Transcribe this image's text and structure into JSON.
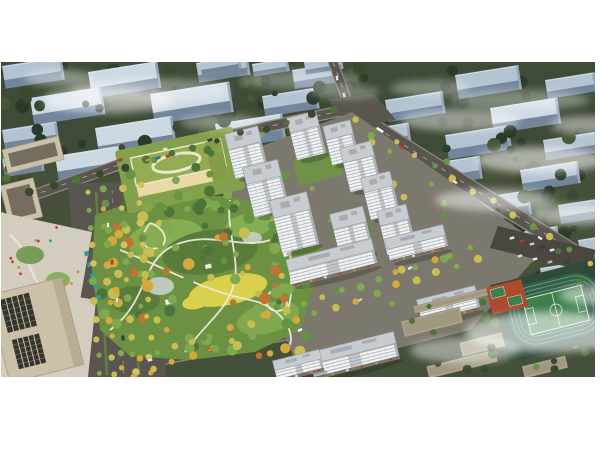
{
  "image": {
    "x": 1,
    "y": 62,
    "width": 594,
    "height": 315,
    "description": "Aerial rendering of a residential masterplan: white high-rise apartment towers around green courtyards, a large landscaped central park with winding paths, a green-roofed kindergarten, beige office buildings on the west, retail mid-rises, a school campus with running track and sports field to the southeast, surrounded by rows of existing slab housing under light mist"
  },
  "palette": {
    "white": "#ffffff",
    "bgGround": "#45503a",
    "bgGroundDark": "#3b4733",
    "dark1": "#2c3a2b",
    "dark2": "#39492f",
    "dark3": "#465739",
    "slabRoof": "#b4c3d1",
    "slabRoofLight": "#ccd8e2",
    "slabFace": "#73859a",
    "slabEnd": "#92a4b4",
    "road": "#5a564f",
    "roadDark": "#4d4a44",
    "roadLine": "#d8d3c7",
    "sidewalk": "#8f8a80",
    "parcel": "#7d786d",
    "towerRoof": "#c7ccd1",
    "towerRoofEdge": "#99a0a7",
    "towerSide": "#a9b0b7",
    "towerBox": "#a5acb2",
    "towerShadow": "rgba(30,35,30,0.28)",
    "courtyard": "#5e8142",
    "podium": "#6f9149",
    "podium2": "#68894a",
    "parkBase": "#6d9142",
    "parkLight": "#86ad51",
    "parkDark": "#597c3a",
    "lawnYellow": "#d9d04b",
    "pond": "#c5d0c9",
    "path": "#efe9da",
    "g1": "#4d7338",
    "g2": "#679344",
    "g3": "#7fa84f",
    "tY": "#c8bd52",
    "tY2": "#cfc35a",
    "tGold": "#d5a93e",
    "tOr": "#c07433",
    "schoolRoof": "#94ab51",
    "schoolRoofDark": "#869c49",
    "schoolRing": "#e6e9c6",
    "schoolWall": "#e9d9a4",
    "schoolWallLight": "#f2ead2",
    "schoolLawn": "#85a04c",
    "beige": "#cbc0a8",
    "beigeDark": "#a89c82",
    "officeWin": "#35352f",
    "plaza": "#d3cdc0",
    "canopy": "#2f9e98",
    "campusBeige": "#b3a98f",
    "campusEdge": "#8f8570",
    "campusRoof": "#8d8672",
    "trackGround": "#2f4a3a",
    "trackGreen": "#326147",
    "trackLane": "#86a695",
    "pitchGreen": "#3f7f4b",
    "pitchLine": "#d9e6da",
    "courtRed": "#b04a2e",
    "parking": "#4a4741",
    "shopStrip": "#77726a",
    "awn1": "#c23b2e",
    "awn2": "#d98a2b",
    "awn3": "#ededed"
  },
  "scene": {
    "bgTrees1": [
      {
        "x": 0,
        "y": 62,
        "w": 360,
        "h": 108,
        "n": 60,
        "r": [
          3,
          8
        ],
        "colors": [
          "dark1",
          "dark2",
          "dark3"
        ],
        "seed": 11
      },
      {
        "x": 340,
        "y": 62,
        "w": 255,
        "h": 72,
        "n": 32,
        "r": [
          3,
          7
        ],
        "colors": [
          "dark1",
          "dark2"
        ],
        "seed": 23
      },
      {
        "x": 420,
        "y": 128,
        "w": 175,
        "h": 172,
        "n": 48,
        "r": [
          3,
          8
        ],
        "colors": [
          "dark1",
          "dark2",
          "dark3"
        ],
        "seed": 37
      }
    ],
    "bgSlabs": [
      [
        2,
        66,
        60
      ],
      [
        88,
        72,
        70
      ],
      [
        196,
        63,
        52
      ],
      [
        292,
        70,
        48
      ],
      [
        200,
        62,
        40,
        1
      ],
      [
        252,
        64,
        36,
        1
      ],
      [
        304,
        62,
        38,
        1
      ],
      [
        30,
        98,
        72
      ],
      [
        150,
        94,
        80
      ],
      [
        262,
        96,
        55
      ],
      [
        2,
        130,
        55
      ],
      [
        95,
        128,
        78
      ],
      [
        215,
        124,
        68
      ],
      [
        2,
        158,
        40
      ],
      [
        55,
        156,
        66
      ],
      [
        455,
        75,
        64
      ],
      [
        545,
        80,
        50
      ],
      [
        385,
        100,
        58
      ],
      [
        490,
        108,
        68
      ],
      [
        355,
        131,
        54
      ],
      [
        445,
        135,
        64
      ],
      [
        543,
        140,
        54
      ],
      [
        420,
        165,
        60
      ],
      [
        520,
        170,
        58
      ],
      [
        465,
        200,
        64
      ],
      [
        558,
        205,
        42
      ],
      [
        500,
        235,
        58
      ],
      [
        578,
        240,
        30
      ],
      [
        540,
        268,
        52
      ]
    ],
    "bgTrees2": [
      {
        "x": 0,
        "y": 70,
        "w": 350,
        "h": 100,
        "n": 26,
        "r": [
          3,
          7
        ],
        "colors": [
          "dark1",
          "dark2"
        ],
        "seed": 51
      },
      {
        "x": 430,
        "y": 130,
        "w": 165,
        "h": 165,
        "n": 24,
        "r": [
          3,
          7
        ],
        "colors": [
          "dark1",
          "dark3"
        ],
        "seed": 63
      },
      {
        "x": 0,
        "y": 150,
        "w": 22,
        "h": 120,
        "n": 10,
        "r": [
          3,
          6
        ],
        "colors": [
          "g1",
          "dark2"
        ],
        "seed": 71
      }
    ],
    "mistBack": [
      [
        150,
        90,
        80,
        12,
        0.35
      ],
      [
        300,
        80,
        60,
        9,
        0.3
      ],
      [
        520,
        100,
        70,
        10,
        0.35
      ]
    ],
    "roads": {
      "r1": {
        "pts": "20,200 160,150 345,110",
        "w": 9
      },
      "stub": {
        "pts": "333,62 351,111",
        "w": 8
      },
      "r2": {
        "pts": "348,110 600,268",
        "w": 13
      },
      "south": {
        "pts": "85,374 290,333 505,238",
        "w": 11
      }
    },
    "westAvenue": {
      "poly": "68,184 154,180 166,377 84,377",
      "medians": [
        [
          "96,192",
          "107,375"
        ],
        [
          "124,189",
          "139,375"
        ]
      ]
    },
    "intersection": {
      "poly": "328,99 374,94 396,120 350,128"
    },
    "parcel": {
      "poly": "225,160 352,112 545,248 470,330 310,370 295,360 230,205"
    },
    "parcelTrees": {
      "x": 235,
      "y": 135,
      "w": 215,
      "h": 170,
      "n": 34,
      "r": [
        2,
        4.5
      ],
      "colors": [
        "g2",
        "g3",
        "tY"
      ],
      "seed": 83
    },
    "courtyards": [
      {
        "cx": 318,
        "cy": 168,
        "w": 46,
        "h": 26,
        "rot": -14,
        "color": "podium"
      },
      {
        "cx": 352,
        "cy": 232,
        "w": 38,
        "h": 22,
        "rot": -14,
        "color": "podium2"
      },
      {
        "cx": 268,
        "cy": 238,
        "w": 30,
        "h": 18,
        "rot": -14,
        "color": "courtyard"
      }
    ],
    "park": {
      "poly": "95,215 150,196 230,196 300,214 322,250 310,300 300,330 255,352 190,360 130,356 100,330 92,270",
      "patches": [
        [
          165,
          238,
          38,
          18,
          "parkLight",
          -10
        ],
        [
          268,
          318,
          32,
          15,
          "g3",
          -15
        ],
        [
          210,
          252,
          48,
          22,
          "parkDark",
          -8
        ],
        [
          228,
          290,
          40,
          15,
          "lawnYellow",
          -12
        ],
        [
          196,
          302,
          14,
          7,
          "lawnYellow",
          -12
        ],
        [
          250,
          225,
          25,
          12,
          "parkLight",
          -10
        ],
        [
          135,
          300,
          25,
          14,
          "parkDark",
          0
        ],
        [
          295,
          260,
          20,
          12,
          "g2",
          0
        ]
      ],
      "ponds": [
        [
          160,
          286,
          14,
          9
        ],
        [
          252,
          238,
          10,
          6
        ]
      ],
      "paths": [
        "M 110,330 C 150,300 140,260 175,245 C 210,230 240,250 270,240",
        "M 120,250 C 160,265 200,290 250,300 C 280,306 295,330 290,345",
        "M 230,200 C 225,235 245,265 230,295 C 222,313 200,330 185,352",
        "M 300,225 C 280,250 300,290 285,315",
        "M 150,223 C 138,238 142,252 158,248 C 170,244 166,228 150,223",
        "M 270,292 C 262,304 270,314 282,310 C 292,306 286,294 270,292"
      ],
      "pavilions": [
        [
          165,
          300,
          8,
          5
        ],
        [
          205,
          265,
          6,
          4
        ],
        [
          283,
          252,
          7,
          5
        ]
      ]
    },
    "parkTrees": [
      {
        "x": 100,
        "y": 200,
        "w": 212,
        "h": 156,
        "n": 115,
        "r": [
          2.5,
          6
        ],
        "colors": [
          "g1",
          "g2",
          "g2",
          "g3",
          "g3",
          "tY",
          "tGold",
          "tOr"
        ],
        "seed": 97
      },
      {
        "x": 150,
        "y": 194,
        "w": 145,
        "h": 20,
        "n": 18,
        "r": [
          3,
          5.5
        ],
        "colors": [
          "g1",
          "g2",
          "g3"
        ],
        "seed": 101
      }
    ],
    "school": {
      "cx": 180,
      "cy": 170,
      "rot": -12,
      "trees": {
        "x": 118,
        "y": 138,
        "w": 125,
        "h": 72,
        "n": 16,
        "r": [
          3,
          5.5
        ],
        "colors": [
          "g1",
          "g2",
          "g3"
        ],
        "seed": 113
      }
    },
    "officeNW": {
      "bldgs": [
        [
          2,
          150,
          58,
          24
        ],
        [
          0,
          186,
          34,
          40
        ]
      ],
      "garden": {
        "poly": "0,212 92,232 78,312 0,302",
        "dots": {
          "n": 14,
          "x": 8,
          "y": 225,
          "w": 70,
          "h": 75,
          "seed": 131,
          "colors": [
            "canopy",
            "awn2",
            "white",
            "awn1",
            "g3"
          ]
        }
      },
      "canopies": [
        [
          84,
          252
        ],
        [
          87,
          263
        ],
        [
          90,
          274
        ],
        [
          93,
          285
        ],
        [
          96,
          296
        ]
      ]
    },
    "officeTower": {
      "plaza": "0,284 96,300 88,377 0,377",
      "cx": 36,
      "cy": 330
    },
    "towers": [
      [
        243,
        138,
        34,
        16,
        30
      ],
      [
        303,
        122,
        30,
        15,
        28
      ],
      [
        338,
        130,
        28,
        14,
        26
      ],
      [
        262,
        172,
        36,
        17,
        34
      ],
      [
        357,
        152,
        32,
        15,
        30
      ],
      [
        377,
        182,
        30,
        15,
        28
      ],
      [
        290,
        205,
        38,
        18,
        36
      ],
      [
        348,
        218,
        34,
        16,
        32
      ],
      [
        393,
        215,
        30,
        15,
        30
      ]
    ],
    "retail": [
      [
        330,
        255,
        88,
        12,
        16
      ],
      [
        415,
        237,
        60,
        11,
        14
      ],
      [
        352,
        348,
        88,
        12,
        16
      ],
      [
        297,
        360,
        48,
        10,
        12
      ],
      [
        447,
        298,
        60,
        11,
        14
      ]
    ],
    "campus": {
      "bldgs": [
        [
          470,
          296,
          115,
          7
        ],
        [
          432,
          322,
          60,
          16
        ],
        [
          500,
          340,
          80,
          14
        ],
        [
          462,
          364,
          70,
          12
        ],
        [
          545,
          367,
          44,
          12
        ]
      ],
      "parking": "498,226 596,250 588,272 490,248",
      "trees": {
        "x": 405,
        "y": 298,
        "w": 180,
        "h": 74,
        "n": 28,
        "r": [
          2.5,
          5
        ],
        "colors": [
          "g1",
          "g2",
          "dark2"
        ],
        "seed": 143
      }
    },
    "sports": {
      "cx": 556,
      "cy": 310,
      "rot": -14,
      "courtsCx": 507,
      "courtsCy": 297
    },
    "treeLines": [
      {
        "f": [
          30,
          193
        ],
        "t": [
          335,
          108
        ],
        "n": 14,
        "r": 3.5,
        "colors": [
          "dark2",
          "g1"
        ],
        "seed": 3
      },
      {
        "f": [
          356,
          118
        ],
        "t": [
          590,
          262
        ],
        "n": 13,
        "r": 3.2,
        "colors": [
          "g2",
          "tY"
        ],
        "seed": 5
      },
      {
        "f": [
          88,
          192
        ],
        "t": [
          100,
          374
        ],
        "n": 11,
        "r": 3.2,
        "colors": [
          "tY",
          "tY2",
          "tGold",
          "g3"
        ],
        "seed": 7
      },
      {
        "f": [
          103,
          190
        ],
        "t": [
          114,
          374
        ],
        "n": 11,
        "r": 3.2,
        "colors": [
          "tY",
          "tGold",
          "g3"
        ],
        "seed": 9
      },
      {
        "f": [
          122,
          188
        ],
        "t": [
          134,
          374
        ],
        "n": 11,
        "r": 3.2,
        "colors": [
          "tY2",
          "tY",
          "g3"
        ],
        "seed": 13
      },
      {
        "f": [
          140,
          186
        ],
        "t": [
          152,
          374
        ],
        "n": 11,
        "r": 3.2,
        "colors": [
          "tY",
          "tGold",
          "tY2"
        ],
        "seed": 15
      },
      {
        "f": [
          120,
          366
        ],
        "t": [
          470,
          248
        ],
        "n": 20,
        "r": 3.4,
        "colors": [
          "tY",
          "tGold",
          "g3"
        ],
        "seed": 17
      },
      {
        "f": [
          132,
          377
        ],
        "t": [
          478,
          258
        ],
        "n": 18,
        "r": 3.4,
        "colors": [
          "tY",
          "g3",
          "tGold"
        ],
        "seed": 19
      },
      {
        "f": [
          560,
          252
        ],
        "t": [
          592,
          300
        ],
        "n": 6,
        "r": 3.5,
        "colors": [
          "g1",
          "dark2"
        ],
        "seed": 21
      }
    ],
    "cars": [
      [
        120,
        160,
        "#c23b2e",
        -20
      ],
      [
        165,
        149,
        "#e8e8e8",
        -18
      ],
      [
        210,
        140,
        "#3a3f46",
        -18
      ],
      [
        337,
        78,
        "#e8e8e8",
        80
      ],
      [
        344,
        95,
        "#d8d8d8",
        80
      ],
      [
        380,
        130,
        "#ffffff",
        33,
        8
      ],
      [
        402,
        147,
        "#c23b2e",
        33
      ],
      [
        455,
        182,
        "#e8e8e8",
        33
      ],
      [
        498,
        210,
        "#2f343a",
        33
      ],
      [
        540,
        238,
        "#e8e8e8",
        33
      ],
      [
        108,
        225,
        "#e8e8e8",
        87
      ],
      [
        112,
        262,
        "#c23b2e",
        87
      ],
      [
        117,
        300,
        "#dddddd",
        87
      ],
      [
        123,
        338,
        "#33373d",
        87
      ],
      [
        150,
        360,
        "#e8e8e8",
        -10
      ],
      [
        210,
        350,
        "#d98a2b",
        -12
      ],
      [
        300,
        330,
        "#ffffff",
        -25
      ],
      [
        360,
        300,
        "#cccccc",
        -28
      ],
      [
        410,
        268,
        "#e8e8e8",
        -28
      ],
      [
        148,
        160,
        "#c2a32e",
        -18
      ],
      [
        158,
        158,
        "#3a6fb0",
        -18
      ],
      [
        168,
        156,
        "#c23b2e",
        -18
      ],
      [
        178,
        154,
        "#e8e8e8",
        -18
      ],
      [
        512,
        238,
        "#e8e8e8",
        -14
      ],
      [
        522,
        241,
        "#c23b2e",
        -14
      ],
      [
        532,
        244,
        "#cccccc",
        -14
      ],
      [
        542,
        247,
        "#3a3f46",
        -14
      ],
      [
        552,
        250,
        "#e8e8e8",
        -14
      ],
      [
        520,
        256,
        "#dddddd",
        -14
      ],
      [
        535,
        259,
        "#e8e8e8",
        -14
      ],
      [
        550,
        262,
        "#b7b7b7",
        -14
      ]
    ],
    "mistFront": [
      [
        108,
        100,
        65,
        13,
        0.5
      ],
      [
        60,
        78,
        35,
        8,
        0.4
      ],
      [
        220,
        122,
        40,
        8,
        0.35
      ],
      [
        345,
        92,
        35,
        7,
        0.3
      ],
      [
        430,
        88,
        40,
        8,
        0.35
      ],
      [
        460,
        120,
        60,
        11,
        0.45
      ],
      [
        585,
        125,
        35,
        9,
        0.45
      ],
      [
        540,
        160,
        65,
        13,
        0.55
      ],
      [
        495,
        200,
        60,
        11,
        0.5
      ],
      [
        575,
        215,
        45,
        10,
        0.5
      ],
      [
        550,
        332,
        85,
        20,
        0.6
      ],
      [
        465,
        350,
        55,
        13,
        0.45
      ],
      [
        595,
        295,
        35,
        10,
        0.5
      ]
    ]
  }
}
